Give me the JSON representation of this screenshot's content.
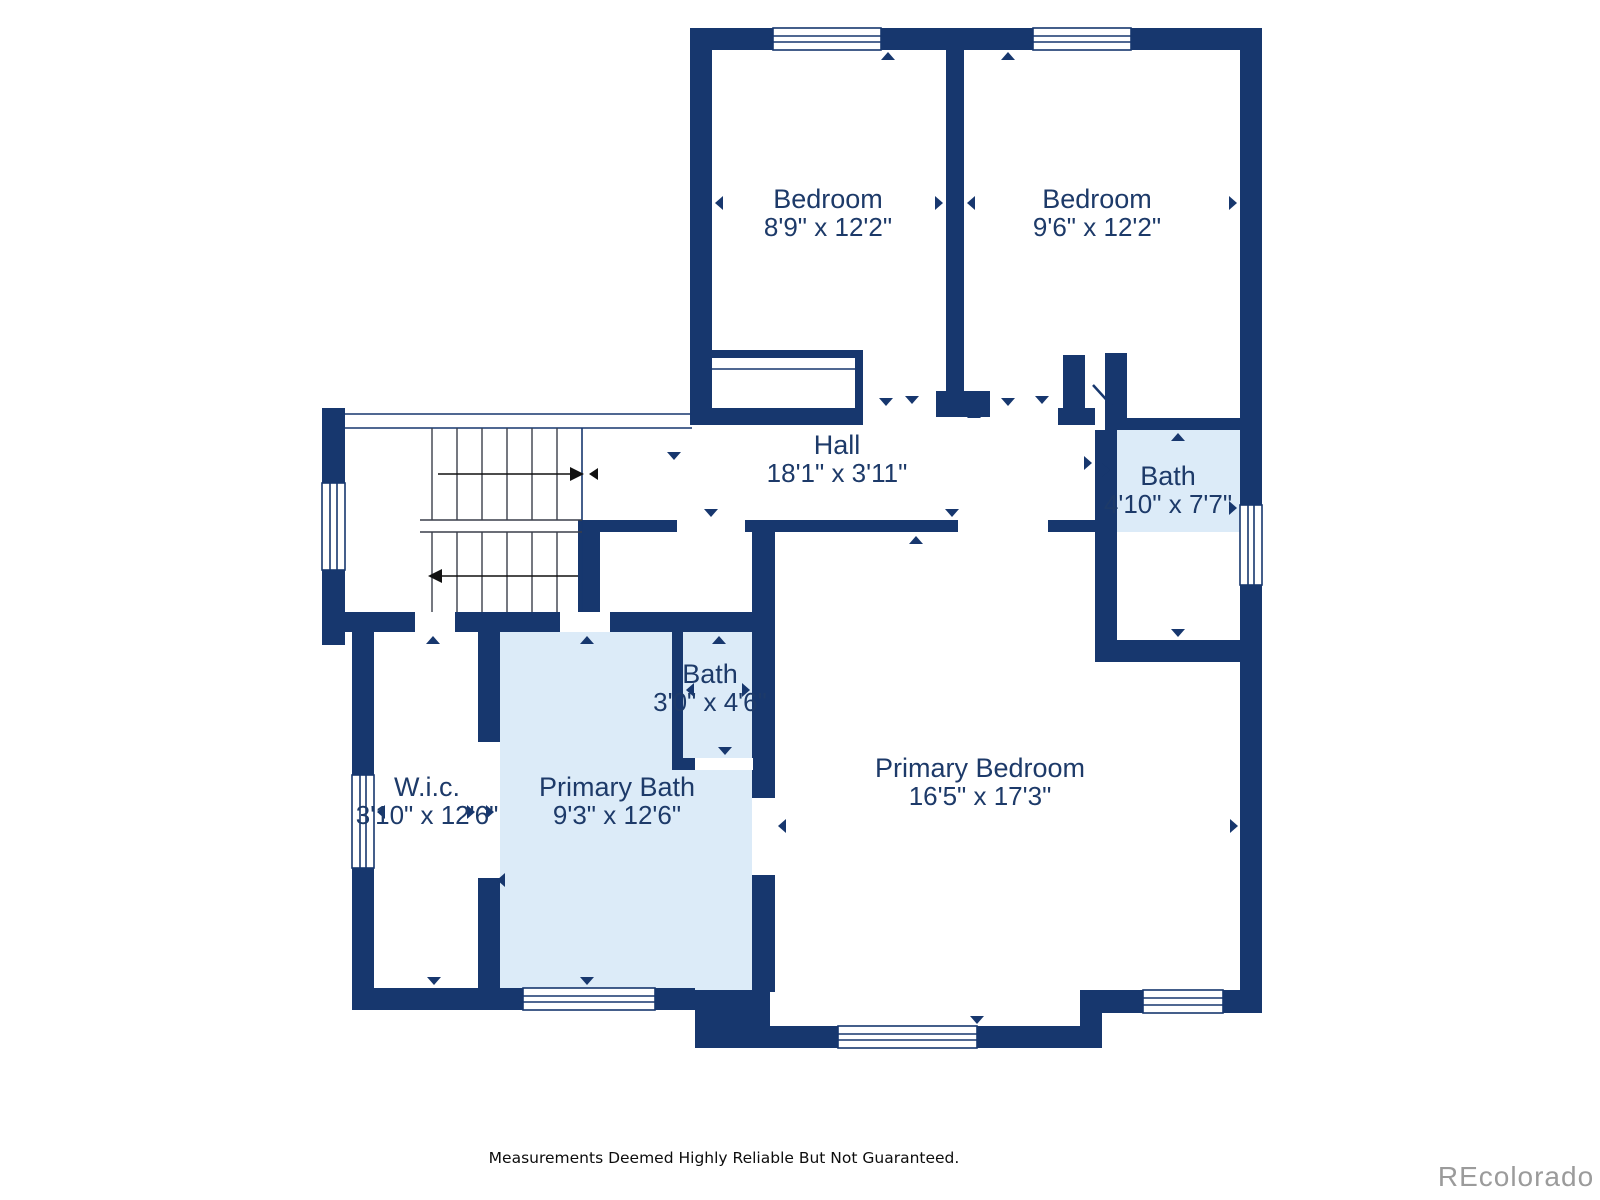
{
  "colors": {
    "wall": "#17376e",
    "bath_fill": "#dcebf8",
    "room_fill": "#ffffff",
    "label": "#1d3a69",
    "watermark": "#9b9b9b"
  },
  "rooms": {
    "bedroom_left": {
      "name": "Bedroom",
      "dims": "8'9\" x 12'2\""
    },
    "bedroom_right": {
      "name": "Bedroom",
      "dims": "9'6\" x 12'2\""
    },
    "hall": {
      "name": "Hall",
      "dims": "18'1\" x 3'11\""
    },
    "bath_upper": {
      "name": "Bath",
      "dims": "4'10\" x 7'7\""
    },
    "bath_small": {
      "name": "Bath",
      "dims": "3'0\" x 4'6\""
    },
    "wic": {
      "name": "W.i.c.",
      "dims": "3'10\" x 12'6\""
    },
    "primary_bath": {
      "name": "Primary Bath",
      "dims": "9'3\" x 12'6\""
    },
    "primary_bedroom": {
      "name": "Primary Bedroom",
      "dims": "16'5\" x 17'3\""
    }
  },
  "footer": {
    "disclaimer": "Measurements Deemed Highly Reliable But Not Guaranteed."
  },
  "watermark": {
    "text": "REcolorado"
  }
}
